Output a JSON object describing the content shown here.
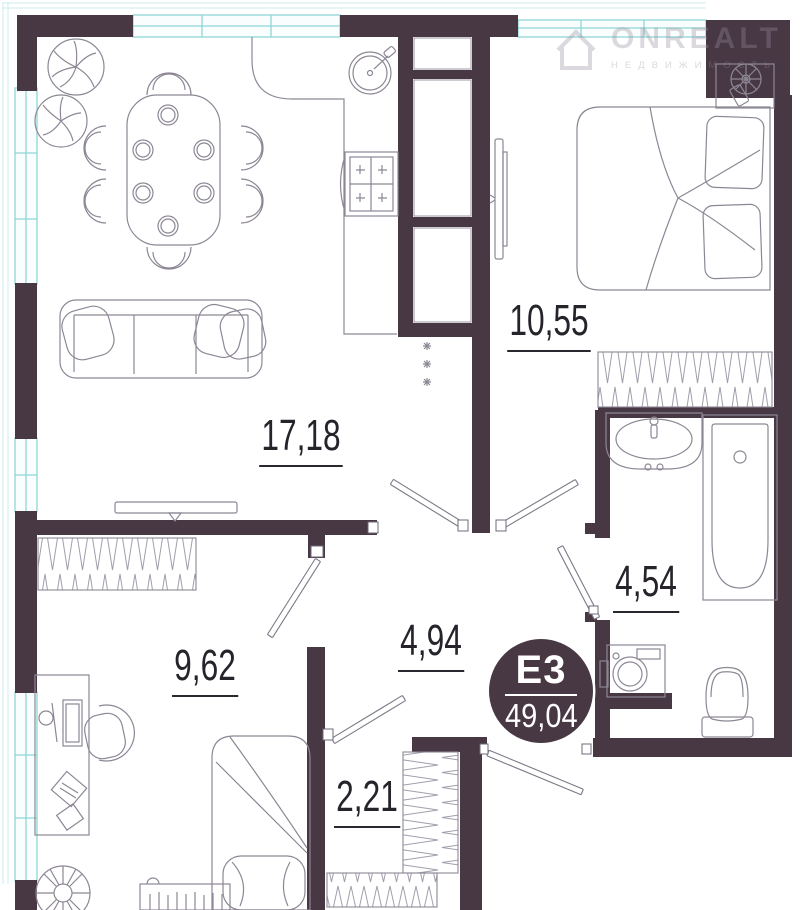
{
  "watermark": {
    "brand": "ONREALT",
    "tagline": "НЕДВИЖИМОСТЬ"
  },
  "unit_badge": {
    "unit": "E3",
    "total_area": "49,04"
  },
  "rooms": [
    {
      "id": "living-kitchen",
      "label": "17,18"
    },
    {
      "id": "bedroom",
      "label": "10,55"
    },
    {
      "id": "bathroom",
      "label": "4,54"
    },
    {
      "id": "room",
      "label": "9,62"
    },
    {
      "id": "hallway",
      "label": "4,94"
    },
    {
      "id": "wardrobe",
      "label": "2,21"
    }
  ],
  "palette": {
    "wall": "#483844",
    "window": "#8fd6d6",
    "outline": "#8d8795",
    "label": "#26232a"
  },
  "furniture_icons": [
    "dining-table-icon",
    "dining-chair-icon",
    "plant-icon",
    "sofa-icon",
    "tv-icon",
    "kitchen-counter-icon",
    "kitchen-sink-icon",
    "stove-icon",
    "double-bed-icon",
    "dresser-fan-icon",
    "wardrobe-hatch-icon",
    "bath-sink-icon",
    "bathtub-icon",
    "washing-machine-icon",
    "toilet-icon",
    "desk-icon",
    "office-chair-icon",
    "single-bed-icon",
    "bookshelf-icon",
    "door-swing-icon"
  ]
}
